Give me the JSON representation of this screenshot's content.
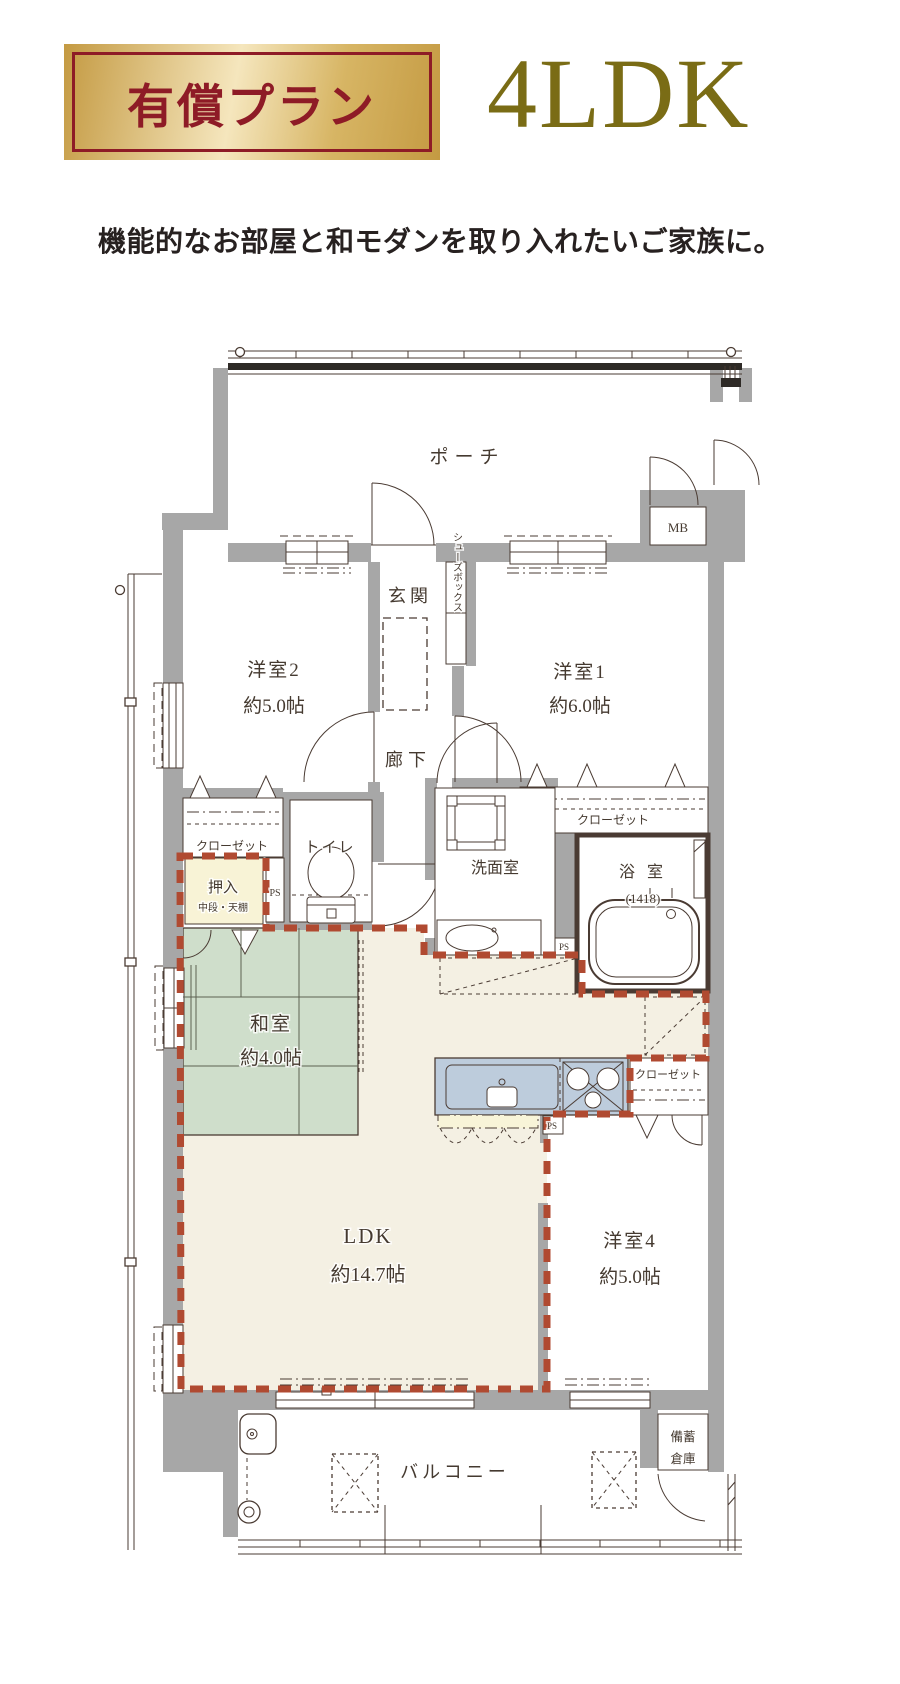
{
  "header": {
    "badge": "有償プラン",
    "plan_type": "4LDK",
    "subtitle": "機能的なお部屋と和モダンを取り入れたいご家族に。"
  },
  "colors": {
    "badge_text": "#8e1b26",
    "gold_dark": "#c49a42",
    "gold_light": "#f5e6bd",
    "gold_mid": "#d7b564",
    "plan_gold": "#7a6c15",
    "wall": "#a7a7a7",
    "line": "#4a3b33",
    "tatami": "#cfdecb",
    "floor": "#f4f0e3",
    "kitchen": "#bdccdc",
    "counter": "#f8f4d8",
    "oshiire": "#f8f3d6",
    "boundary": "#b04a31"
  },
  "floorplan": {
    "porch": "ポーチ",
    "mb": "MB",
    "genkan": "玄関",
    "shoes_box": "シューズボックス",
    "room2": {
      "name": "洋室2",
      "size": "約5.0帖"
    },
    "room1": {
      "name": "洋室1",
      "size": "約6.0帖"
    },
    "hallway": "廊下",
    "closet_room2": "クローゼット",
    "oshiire": {
      "name": "押入",
      "note": "中段・天棚"
    },
    "ps": "PS",
    "toilet": "トイレ",
    "washroom": "洗面室",
    "closet_room1": "クローゼット",
    "bathroom": {
      "name": "浴 室",
      "size": "(1418)"
    },
    "washitsu": {
      "name": "和室",
      "size": "約4.0帖"
    },
    "closet_room4": "クローゼット",
    "ldk": {
      "name": "LDK",
      "size": "約14.7帖"
    },
    "room4": {
      "name": "洋室4",
      "size": "約5.0帖"
    },
    "balcony": "バルコニー",
    "storage": {
      "line1": "備蓄",
      "line2": "倉庫"
    }
  }
}
